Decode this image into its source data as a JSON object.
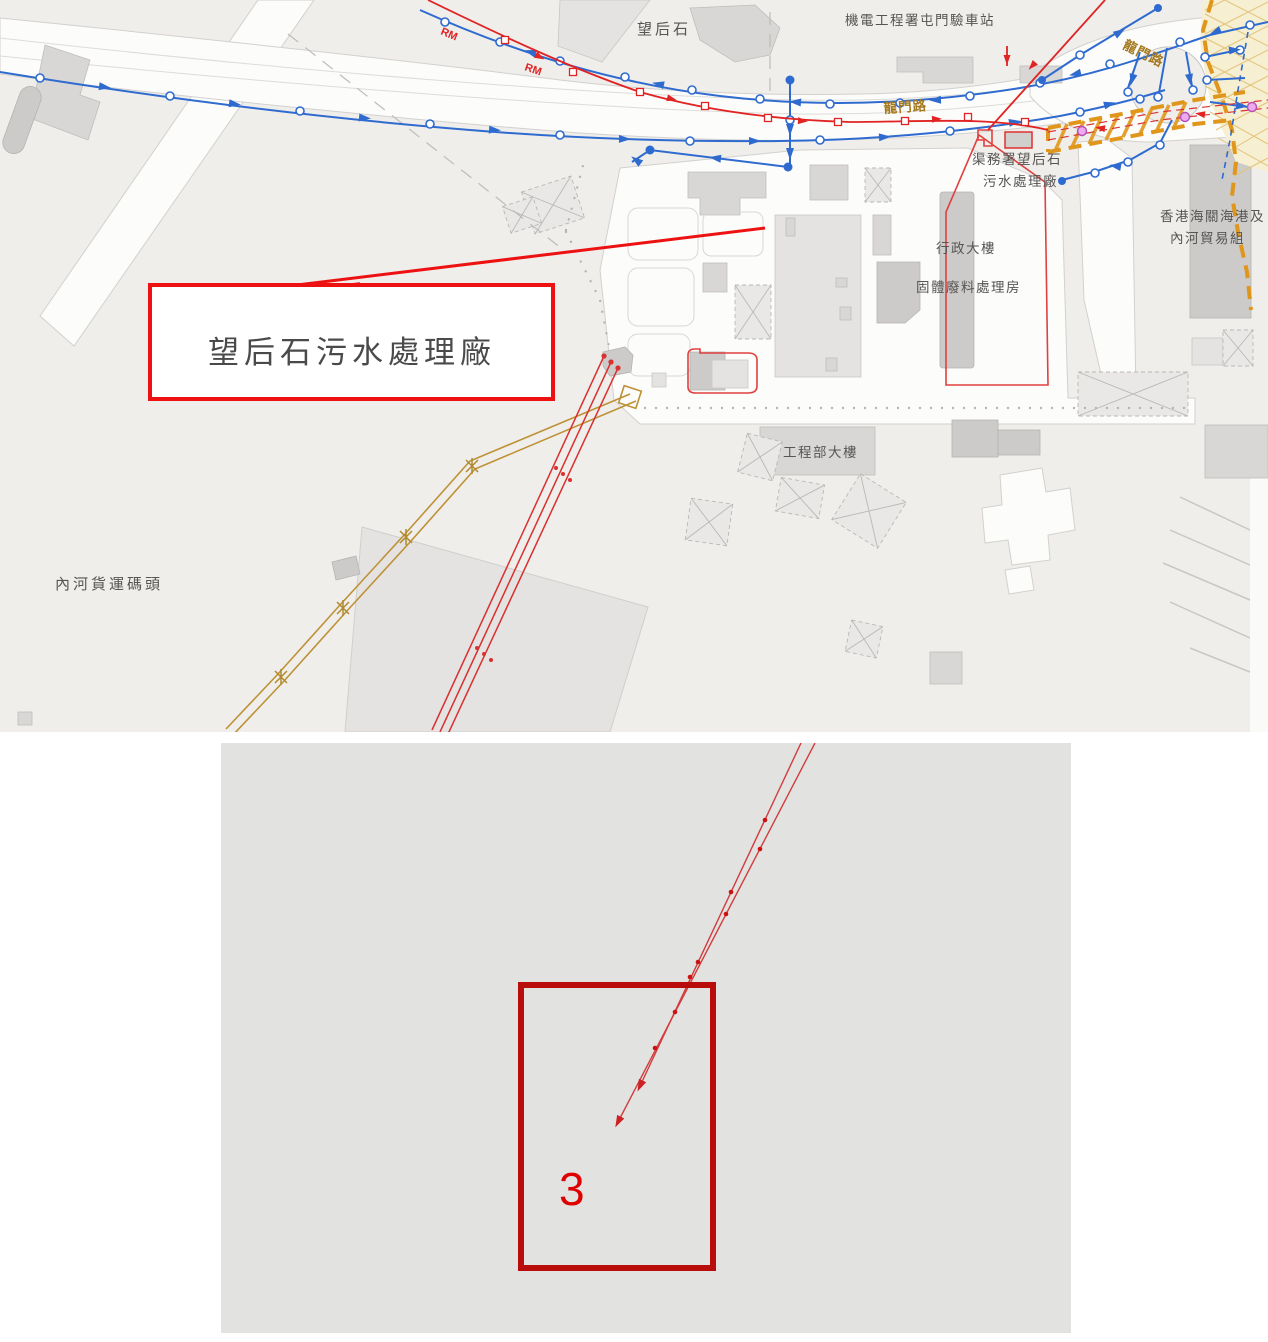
{
  "map": {
    "callout": {
      "label": "望后石污水處理廠"
    },
    "labels": {
      "mong_hau_shek": "望后石",
      "emsd_station": "機電工程署屯門驗車站",
      "lung_mun_road": "龍門路",
      "dsd_plant_line1": "渠務署望后石",
      "dsd_plant_line2": "污水處理廠",
      "admin_building": "行政大樓",
      "solid_waste_building": "固體廢料處理房",
      "engineering_building": "工程部大樓",
      "river_trade_terminal": "內河貨運碼頭",
      "customs_line1": "香港海關海港及",
      "customs_line2": "內河貿易組",
      "rm": "RM"
    },
    "colors": {
      "map_background": "#efeeeb",
      "callout_red": "#ee1111",
      "pipeline_blue": "#2f6bcf",
      "rising_main_red": "#e02424",
      "boundary_orange": "#e0951b",
      "utility_gold": "#be9136",
      "node_magenta": "#b44fb4"
    }
  },
  "inset": {
    "zone_label": "3",
    "colors": {
      "panel_background": "#e2e2e1",
      "zone_red": "#b80d0b",
      "line_red": "#d23c3c"
    }
  }
}
